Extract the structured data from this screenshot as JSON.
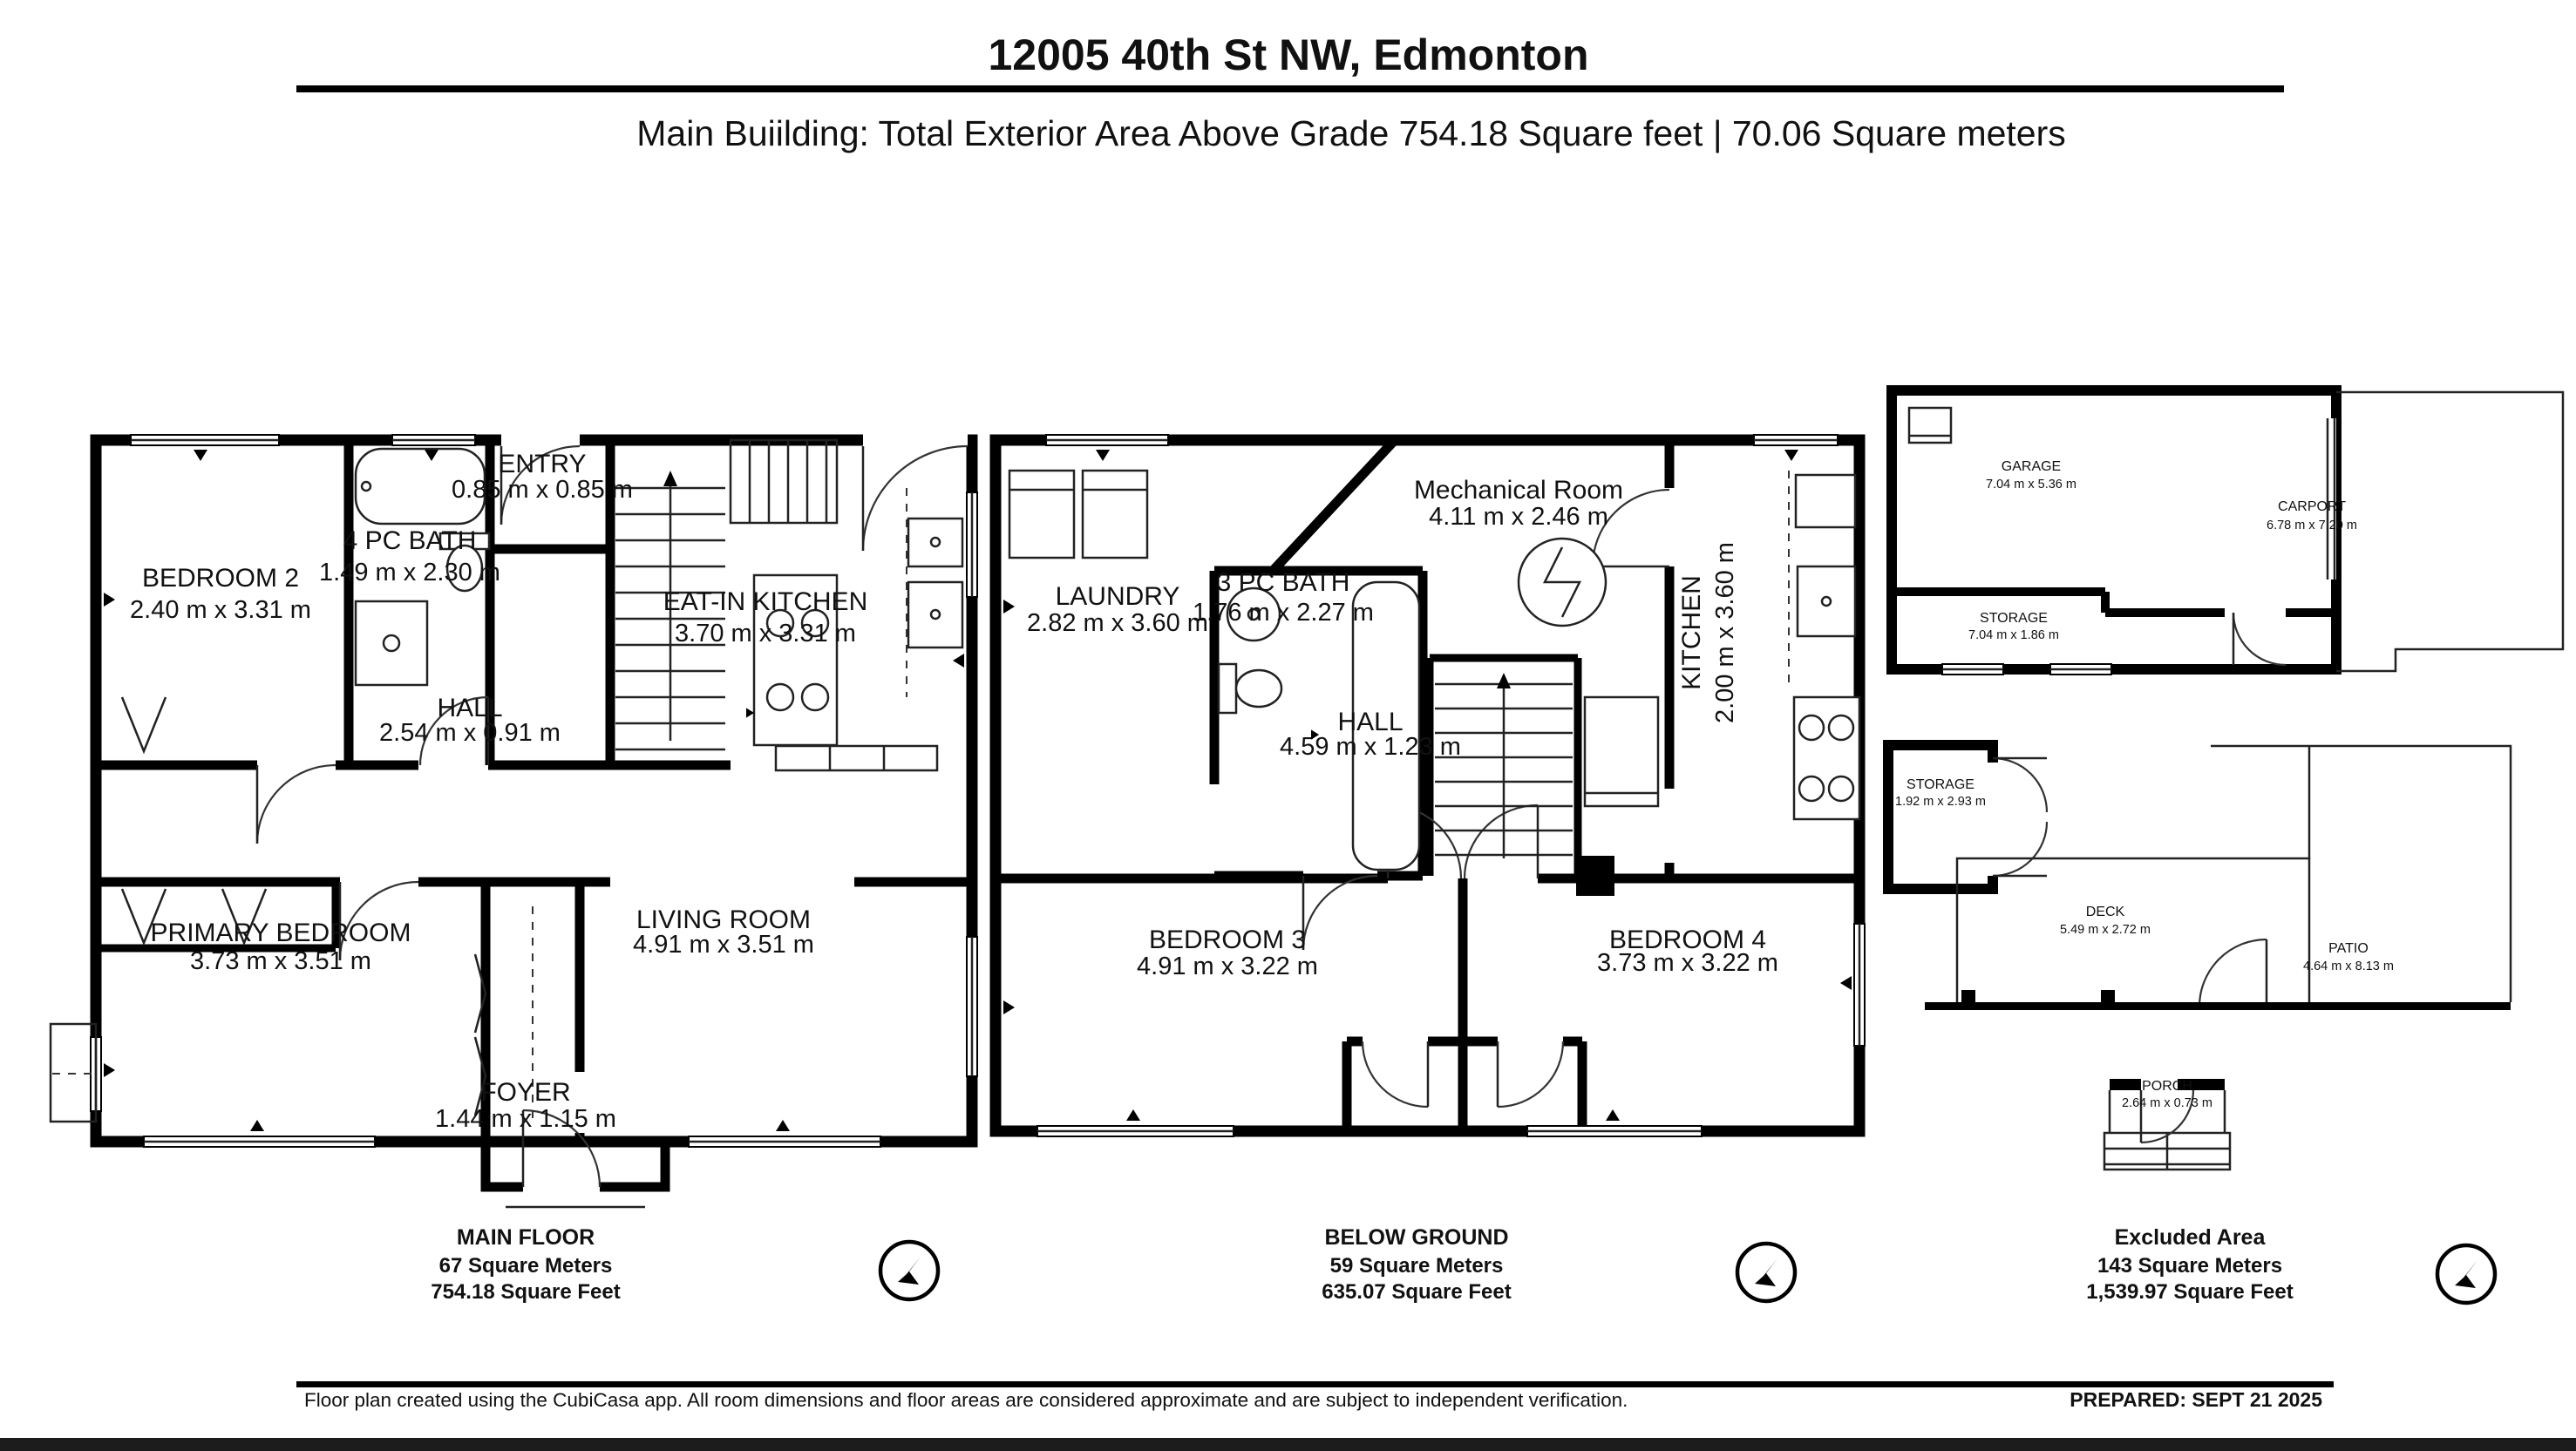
{
  "header": {
    "address": "12005 40th St NW, Edmonton",
    "subtitle": "Main Buiilding: Total Exterior Area Above Grade 754.18 Square feet | 70.06 Square meters"
  },
  "plans": [
    {
      "name": "main-floor",
      "caption": {
        "title": "MAIN FLOOR",
        "area_m": "67 Square Meters",
        "area_ft": "754.18 Square Feet"
      },
      "rooms": [
        {
          "name": "BEDROOM 2",
          "dims": "2.40 m x 3.31 m"
        },
        {
          "name": "4 PC BATH",
          "dims": "1.49 m x 2.30 m"
        },
        {
          "name": "ENTRY",
          "dims": "0.85 m x 0.85 m"
        },
        {
          "name": "EAT-IN KITCHEN",
          "dims": "3.70 m x 3.31 m"
        },
        {
          "name": "HALL",
          "dims": "2.54 m x 0.91 m"
        },
        {
          "name": "PRIMARY BEDROOM",
          "dims": "3.73 m x 3.51 m"
        },
        {
          "name": "LIVING ROOM",
          "dims": "4.91 m x 3.51 m"
        },
        {
          "name": "FOYER",
          "dims": "1.44 m x 1.15 m"
        }
      ]
    },
    {
      "name": "below-ground",
      "caption": {
        "title": "BELOW GROUND",
        "area_m": "59 Square Meters",
        "area_ft": "635.07 Square Feet"
      },
      "rooms": [
        {
          "name": "LAUNDRY",
          "dims": "2.82 m x 3.60 m"
        },
        {
          "name": "3 PC BATH",
          "dims": "1.76 m x 2.27 m"
        },
        {
          "name": "Mechanical Room",
          "dims": "4.11 m x 2.46 m"
        },
        {
          "name": "KITCHEN",
          "dims": "2.00 m x 3.60 m"
        },
        {
          "name": "HALL",
          "dims": "4.59 m x 1.23 m"
        },
        {
          "name": "BEDROOM 3",
          "dims": "4.91 m x 3.22 m"
        },
        {
          "name": "BEDROOM 4",
          "dims": "3.73 m x 3.22 m"
        }
      ]
    },
    {
      "name": "excluded-area",
      "caption": {
        "title": "Excluded Area",
        "area_m": "143 Square Meters",
        "area_ft": "1,539.97 Square Feet"
      },
      "rooms": [
        {
          "name": "GARAGE",
          "dims": "7.04 m x 5.36 m"
        },
        {
          "name": "CARPORT",
          "dims": "6.78 m x 7.20 m"
        },
        {
          "name": "STORAGE",
          "dims": "7.04 m x 1.86 m"
        },
        {
          "name": "STORAGE",
          "dims": "1.92 m x 2.93 m"
        },
        {
          "name": "DECK",
          "dims": "5.49 m x 2.72 m"
        },
        {
          "name": "PATIO",
          "dims": "4.64 m x 8.13 m"
        },
        {
          "name": "PORCH",
          "dims": "2.64 m x 0.73 m"
        }
      ]
    }
  ],
  "footer": {
    "disclaimer": "Floor plan created using the CubiCasa app. All room dimensions and floor areas are considered approximate and are subject to independent verification.",
    "prepared": "PREPARED: SEPT 21 2025"
  },
  "icons": {
    "compass": "north-arrow-compass"
  },
  "colors": {
    "ink": "#000000",
    "background": "#ffffff"
  }
}
